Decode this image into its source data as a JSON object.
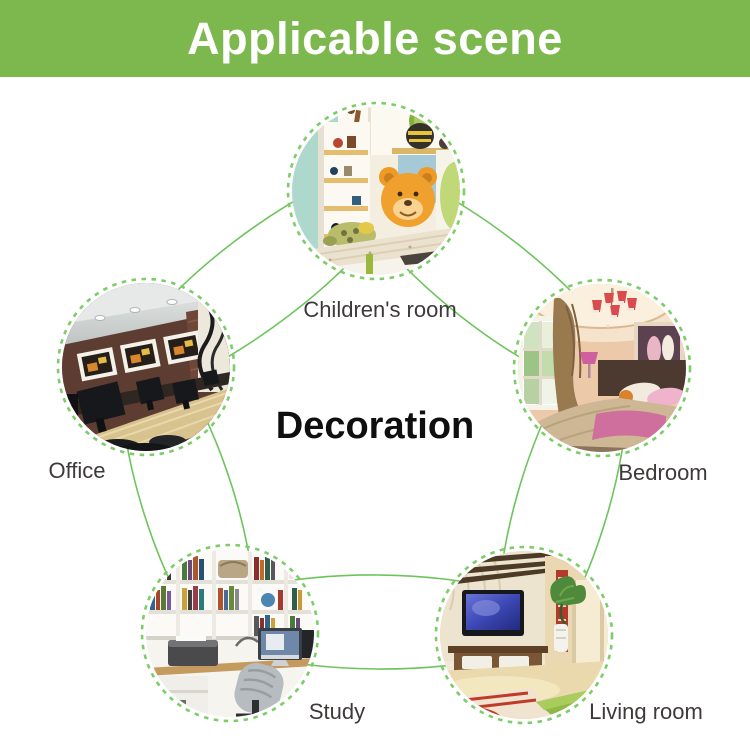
{
  "header": {
    "title": "Applicable scene"
  },
  "center": {
    "title": "Decoration"
  },
  "nodes": [
    {
      "id": "children-room",
      "label": "Children's room",
      "photo": "kids room with shelves, plush bear pillow and low bed"
    },
    {
      "id": "office",
      "label": "Office",
      "photo": "office with brown wall, three framed pictures, long wooden desk with monitors"
    },
    {
      "id": "bedroom",
      "label": "Bedroom",
      "photo": "warm bedroom with chandelier, window, curtain, bed with pink runner"
    },
    {
      "id": "study",
      "label": "Study",
      "photo": "study with white bookshelves, desk computer, printer and chair"
    },
    {
      "id": "living-room",
      "label": "Living room",
      "photo": "living room with wall TV, low cabinet, plant and red-pattern rug"
    }
  ],
  "colors": {
    "banner_green": "#7cb84d",
    "line_green": "#6ec45c",
    "dash_green": "#7ccd68",
    "label_gray": "#3e3a39",
    "title_black": "#0f0f0f"
  }
}
